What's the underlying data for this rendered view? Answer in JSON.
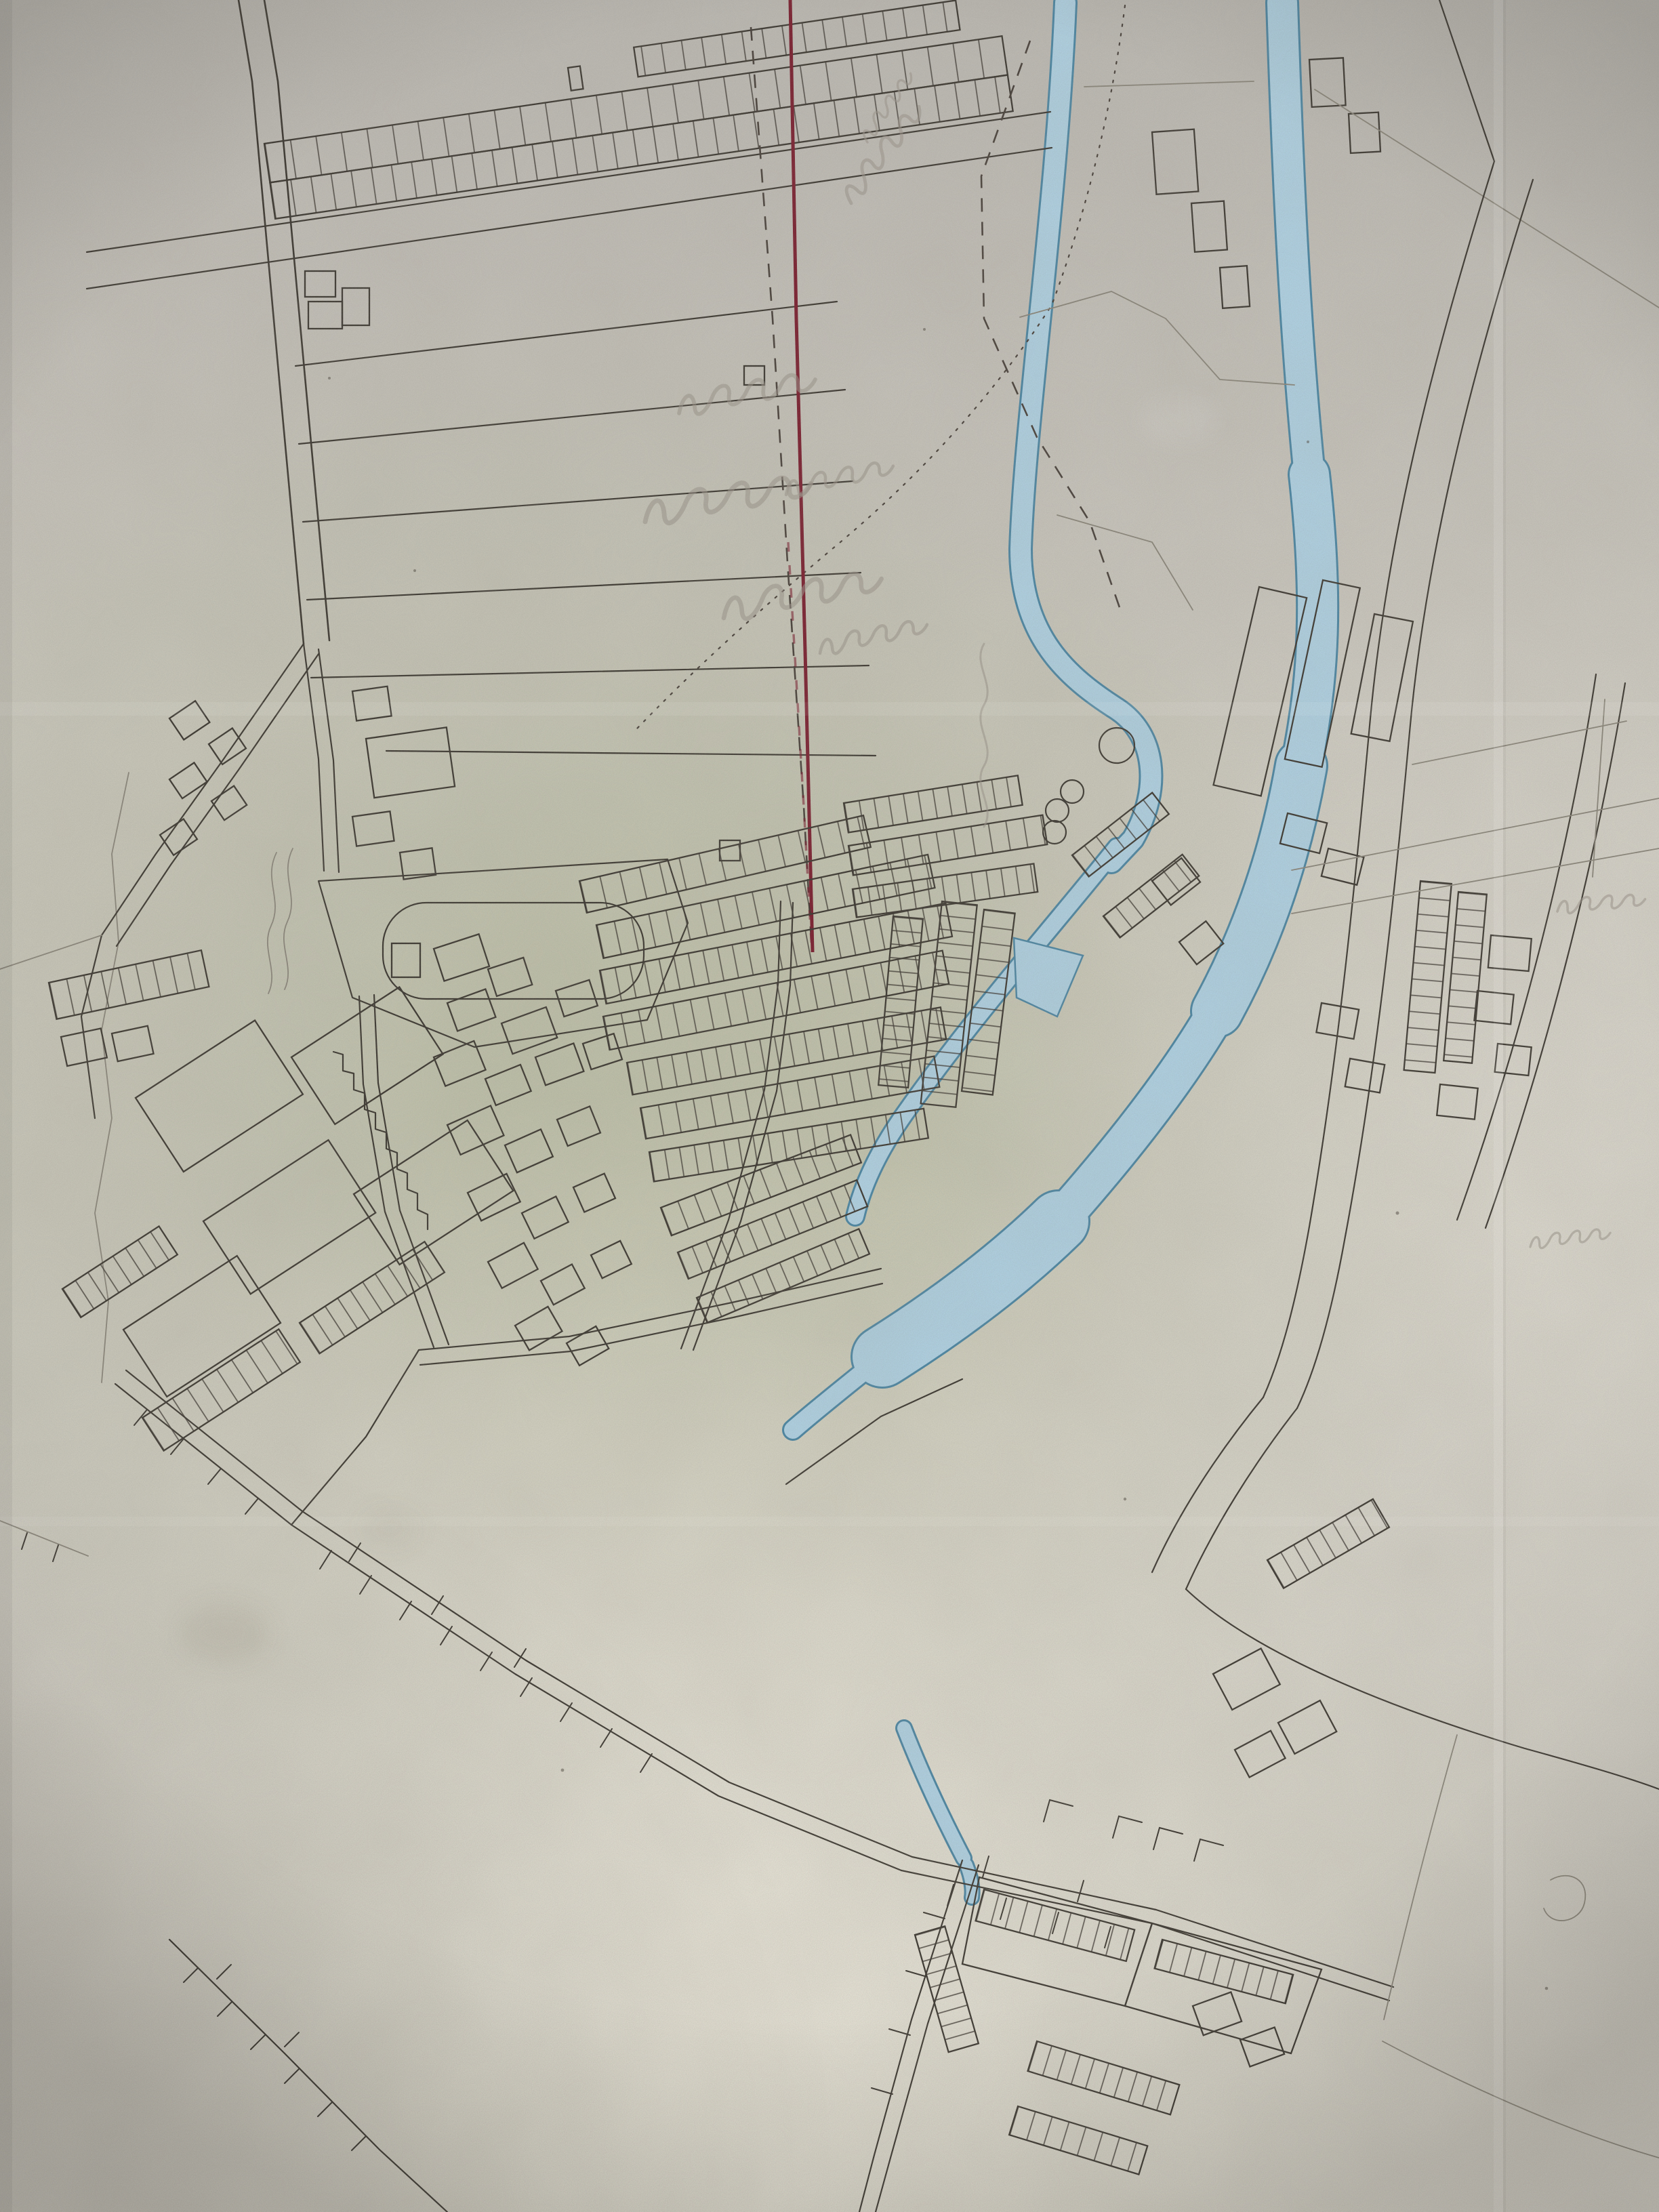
{
  "document": {
    "type": "photograph-of-hand-drawn-map",
    "aria_label": "Photograph of an aged hand-drawn town plan: ink street and building outlines, long field strips at upper left, a blue watercoloured river system flowing from top to centre, a straight dark-red surveyed line, dashed boundary lines and faint illegible pencil field notes on stained paper",
    "visible_text": "none legible (only faint illegible pencil handwriting)"
  },
  "palette": {
    "paper_base": "#cbc8bf",
    "paper_top": "#c2bfbc",
    "paper_sage": "#c2c5ac",
    "paper_bottom": "#dedacd",
    "ink": "#3e3a33",
    "ink_light": "#8a857a",
    "river_fill": "#aecfe0",
    "river_edge": "#4d86a2",
    "red_line": "#7b2030",
    "boundary": "#4a423c",
    "pencil": "#9a948a",
    "stain": "#8d8574"
  },
  "map_features": {
    "field_strips": "long narrow field parcels, upper left",
    "terrace_band": "row of terraced buildings along top road",
    "red_survey_line": "straight dark-red line from top centre ending mid-map",
    "boundary_lines": "black dashed and dotted parish boundaries",
    "west_stream": "narrow blue stream entering top centre, hooks around round tanks",
    "east_river": "wide blue river entering top right, bends south-west",
    "confluence_basin": "wide blue basin where watercourses meet",
    "mill_pond": "small triangular blue pond",
    "round_tanks": "one large and three small circles near stream hook",
    "town_centre": "dense hatched terraced rows and small building lots",
    "stadium_enclosure": "rounded rectangular enclosure west of centre",
    "bottom_streets": "sparse streets with plot tick marks fading toward bottom",
    "pencil_notes": "faint illegible cursive field annotations"
  },
  "annotations": {
    "pencil_notes_count": 10,
    "legible": false
  }
}
